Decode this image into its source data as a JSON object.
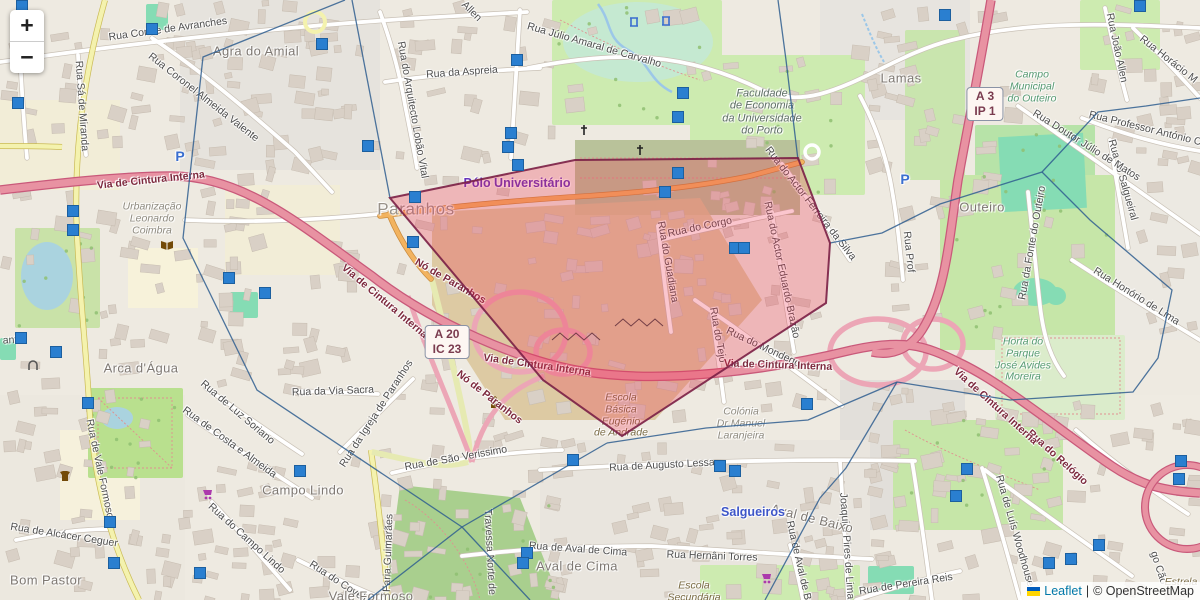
{
  "app": {
    "title": "Leaflet map — Paranhos / Porto"
  },
  "controls": {
    "zoom_in": "+",
    "zoom_out": "−"
  },
  "attribution": {
    "leaflet": "Leaflet",
    "divider": "|",
    "osm": "© OpenStreetMap",
    "flag_top": "#005BBB",
    "flag_bottom": "#FFD500"
  },
  "colors": {
    "highlight_fill": "#ef2e4b",
    "highlight_stroke": "#7a1f45",
    "cell_line": "#2f5e8f",
    "marker_blue": "#2a7fd0",
    "motorway_pink": "#e892a2",
    "leaflet_link": "#0078A8"
  },
  "shields": [
    {
      "lines": [
        "A 20",
        "IC 23"
      ],
      "x": 447,
      "y": 342
    },
    {
      "lines": [
        "A 3",
        "IP 1"
      ],
      "x": 985,
      "y": 104
    }
  ],
  "overlay": {
    "highlight_polygon": [
      [
        390,
        198
      ],
      [
        575,
        160
      ],
      [
        798,
        158
      ],
      [
        830,
        243
      ],
      [
        826,
        303
      ],
      [
        622,
        436
      ],
      [
        543,
        380
      ]
    ],
    "cells": [
      [
        [
          345,
          0
        ],
        [
          203,
          57
        ],
        [
          183,
          238
        ],
        [
          257,
          390
        ],
        [
          462,
          527
        ]
      ],
      [
        [
          462,
          527
        ],
        [
          368,
          600
        ]
      ],
      [
        [
          462,
          527
        ],
        [
          530,
          600
        ]
      ],
      [
        [
          462,
          527
        ],
        [
          607,
          443
        ]
      ],
      [
        [
          352,
          0
        ],
        [
          390,
          198
        ]
      ],
      [
        [
          778,
          0
        ],
        [
          786,
          60
        ],
        [
          798,
          160
        ]
      ],
      [
        [
          830,
          243
        ],
        [
          882,
          233
        ],
        [
          940,
          204
        ],
        [
          1042,
          172
        ],
        [
          1098,
          112
        ],
        [
          1146,
          106
        ],
        [
          1200,
          98
        ]
      ],
      [
        [
          1042,
          172
        ],
        [
          1090,
          220
        ],
        [
          1172,
          290
        ],
        [
          1158,
          358
        ],
        [
          1133,
          392
        ],
        [
          1010,
          400
        ],
        [
          897,
          382
        ]
      ],
      [
        [
          897,
          382
        ],
        [
          846,
          468
        ],
        [
          820,
          498
        ],
        [
          765,
          600
        ]
      ],
      [
        [
          607,
          443
        ],
        [
          706,
          428
        ],
        [
          808,
          420
        ],
        [
          897,
          382
        ]
      ]
    ]
  },
  "map": {
    "labels": [
      {
        "t": "Rua Conde de Avranches",
        "x": 168,
        "y": 30,
        "r": -8,
        "c": "st"
      },
      {
        "t": "Agra do Amial",
        "x": 256,
        "y": 52,
        "r": 0,
        "c": "place"
      },
      {
        "t": "Rua Coronel Almeida Valente",
        "x": 203,
        "y": 98,
        "r": 38,
        "c": "st"
      },
      {
        "t": "Rua Sá de Miranda",
        "x": 81,
        "y": 106,
        "r": 86,
        "c": "st"
      },
      {
        "t": "Rua do Arquitecto Lobão Vital",
        "x": 412,
        "y": 110,
        "r": 80,
        "c": "st"
      },
      {
        "t": "Rua da Aspreia",
        "x": 462,
        "y": 73,
        "r": -4,
        "c": "st"
      },
      {
        "t": "Rua Júlio Amaral de Carvalho",
        "x": 594,
        "y": 46,
        "r": 16,
        "c": "st"
      },
      {
        "t": "Allen",
        "x": 471,
        "y": 12,
        "r": 45,
        "c": "st"
      },
      {
        "t": "Rua João Allen",
        "x": 1116,
        "y": 48,
        "r": 78,
        "c": "st"
      },
      {
        "t": "Rua Horácio M",
        "x": 1168,
        "y": 60,
        "r": 38,
        "c": "st"
      },
      {
        "t": "Rua Professor António Cruz",
        "x": 1152,
        "y": 131,
        "r": 14,
        "c": "st"
      },
      {
        "t": "Rua do Salgueiral",
        "x": 1122,
        "y": 180,
        "r": 74,
        "c": "st"
      },
      {
        "t": "Rua Doutor Júlio de Matos",
        "x": 1086,
        "y": 146,
        "r": 32,
        "c": "st"
      },
      {
        "t": "Rua da Fonte do Outeiro",
        "x": 1033,
        "y": 243,
        "r": -80,
        "c": "st"
      },
      {
        "t": "Rua Honório de Lima",
        "x": 1136,
        "y": 297,
        "r": 32,
        "c": "st"
      },
      {
        "t": "Rua Prof",
        "x": 908,
        "y": 252,
        "r": 84,
        "c": "st"
      },
      {
        "t": "Rua do Corgo",
        "x": 700,
        "y": 228,
        "r": -12,
        "c": "st"
      },
      {
        "t": "Rua do Guadiana",
        "x": 667,
        "y": 262,
        "r": 80,
        "c": "st"
      },
      {
        "t": "Rua do Actor Eduardo Brazão",
        "x": 781,
        "y": 270,
        "r": 78,
        "c": "st"
      },
      {
        "t": "Rua do Actor Ferreira da Silva",
        "x": 810,
        "y": 204,
        "r": 52,
        "c": "st"
      },
      {
        "t": "Rua do Tejo",
        "x": 717,
        "y": 335,
        "r": 80,
        "c": "st"
      },
      {
        "t": "Rua do Mondego",
        "x": 763,
        "y": 348,
        "r": 25,
        "c": "st"
      },
      {
        "t": "Rua do Relógio",
        "x": 1057,
        "y": 458,
        "r": 42,
        "c": "mot"
      },
      {
        "t": "Joaquim Pires de Lima",
        "x": 846,
        "y": 546,
        "r": 86,
        "c": "st"
      },
      {
        "t": "Rua de Pereira Reis",
        "x": 906,
        "y": 585,
        "r": -9,
        "c": "st"
      },
      {
        "t": "Rua de Luís Woodhouse",
        "x": 1014,
        "y": 531,
        "r": 74,
        "c": "st"
      },
      {
        "t": "go Cão",
        "x": 1158,
        "y": 568,
        "r": 72,
        "c": "st"
      },
      {
        "t": "Rua de Augusto Lessa",
        "x": 662,
        "y": 466,
        "r": -3,
        "c": "st"
      },
      {
        "t": "Rua de São Verissimo",
        "x": 456,
        "y": 459,
        "r": -10,
        "c": "st"
      },
      {
        "t": "Travessa Norte de",
        "x": 489,
        "y": 552,
        "r": 87,
        "c": "st"
      },
      {
        "t": "Rua de Aval de Cima",
        "x": 578,
        "y": 550,
        "r": 4,
        "c": "st"
      },
      {
        "t": "Rua Hernâni Torres",
        "x": 712,
        "y": 557,
        "r": 2,
        "c": "st"
      },
      {
        "t": "Rua de Aval de Baixo",
        "x": 800,
        "y": 570,
        "r": 77,
        "c": "st"
      },
      {
        "t": "Rua do Campo Lindo",
        "x": 246,
        "y": 539,
        "r": 42,
        "c": "st"
      },
      {
        "t": "Rua de Luz Soriano",
        "x": 237,
        "y": 413,
        "r": 40,
        "c": "st"
      },
      {
        "t": "Rua de Costa e Almeida",
        "x": 229,
        "y": 443,
        "r": 36,
        "c": "st"
      },
      {
        "t": "Rua de Alcácer Ceguer",
        "x": 64,
        "y": 536,
        "r": 9,
        "c": "st"
      },
      {
        "t": "Rua de Vale Formoso",
        "x": 99,
        "y": 469,
        "r": 78,
        "c": "st"
      },
      {
        "t": "Faria Guimarães",
        "x": 389,
        "y": 553,
        "r": -88,
        "c": "st"
      },
      {
        "t": "Rua do Covelo",
        "x": 339,
        "y": 583,
        "r": 33,
        "c": "st"
      },
      {
        "t": "Rua da Via Sacra",
        "x": 333,
        "y": 392,
        "r": -2,
        "c": "st"
      },
      {
        "t": "Rua da Igreja de Paranhos",
        "x": 377,
        "y": 414,
        "r": -57,
        "c": "st"
      },
      {
        "t": "anto",
        "x": 13,
        "y": 341,
        "r": -3,
        "c": "st"
      },
      {
        "t": "Via de Cintura Interna",
        "x": 151,
        "y": 181,
        "r": -6,
        "c": "mot"
      },
      {
        "t": "Via de Cintura Interna",
        "x": 384,
        "y": 302,
        "r": 40,
        "c": "mot"
      },
      {
        "t": "Via de Cintura Interna",
        "x": 537,
        "y": 366,
        "r": 8,
        "c": "mot"
      },
      {
        "t": "Via de Cintura Interna",
        "x": 778,
        "y": 366,
        "r": 2,
        "c": "mot"
      },
      {
        "t": "Via de Cintura Interna",
        "x": 995,
        "y": 407,
        "r": 42,
        "c": "mot"
      },
      {
        "t": "Nó de Paranhos",
        "x": 450,
        "y": 282,
        "r": 30,
        "c": "mot"
      },
      {
        "t": "Nó de Paranhos",
        "x": 489,
        "y": 398,
        "r": 38,
        "c": "mot"
      },
      {
        "t": "Lamas",
        "x": 901,
        "y": 79,
        "r": 0,
        "c": "place"
      },
      {
        "t": "Outeiro",
        "x": 982,
        "y": 208,
        "r": 0,
        "c": "place"
      },
      {
        "t": "Paranhos",
        "x": 416,
        "y": 209,
        "r": 0,
        "c": "place-lg"
      },
      {
        "t": "Arca d'Água",
        "x": 141,
        "y": 369,
        "r": 0,
        "c": "place"
      },
      {
        "t": "Campo Lindo",
        "x": 303,
        "y": 491,
        "r": 0,
        "c": "place"
      },
      {
        "t": "Aval de Cima",
        "x": 577,
        "y": 567,
        "r": 0,
        "c": "place"
      },
      {
        "t": "Aval de Baixo",
        "x": 812,
        "y": 519,
        "r": 14,
        "c": "place"
      },
      {
        "t": "Bom Pastor",
        "x": 46,
        "y": 581,
        "r": 0,
        "c": "place"
      },
      {
        "t": "Vale Formoso",
        "x": 371,
        "y": 597,
        "r": 0,
        "c": "place"
      },
      {
        "t": "Salgueiros",
        "x": 753,
        "y": 512,
        "r": 0,
        "c": "place-blue"
      },
      {
        "t": "Pólo Universitário",
        "x": 517,
        "y": 183,
        "r": 0,
        "c": "purple"
      },
      {
        "t": "Estrela",
        "x": 1181,
        "y": 583,
        "r": 0,
        "c": "school-italic"
      },
      {
        "t": "P",
        "x": 180,
        "y": 157,
        "r": 0,
        "c": "p-icon"
      },
      {
        "t": "P",
        "x": 905,
        "y": 180,
        "r": 0,
        "c": "p-icon"
      },
      {
        "lines": [
          "Faculdade",
          "de Economia",
          "da Universidade",
          "do Porto"
        ],
        "x": 762,
        "y": 112,
        "c": "uni"
      },
      {
        "lines": [
          "Urbanização",
          "Leonardo",
          "Coimbra"
        ],
        "x": 152,
        "y": 219,
        "c": "muted-italic"
      },
      {
        "lines": [
          "Campo",
          "Municipal",
          "do Outeiro"
        ],
        "x": 1032,
        "y": 87,
        "c": "green-italic"
      },
      {
        "lines": [
          "Horta do",
          "Parque",
          "José Avides",
          "Moreira"
        ],
        "x": 1023,
        "y": 360,
        "c": "green-italic"
      },
      {
        "lines": [
          "Escola",
          "Básica",
          "Eugénio",
          "de Andrade"
        ],
        "x": 621,
        "y": 416,
        "c": "school-italic"
      },
      {
        "lines": [
          "Colónia",
          "Dr Manuel",
          "Laranjeira"
        ],
        "x": 741,
        "y": 424,
        "c": "muted-italic"
      },
      {
        "lines": [
          "Escola",
          "Secundária",
          "de António"
        ],
        "x": 694,
        "y": 598,
        "c": "school-italic"
      }
    ],
    "markers": [
      {
        "x": 22,
        "y": 6
      },
      {
        "x": 152,
        "y": 29
      },
      {
        "x": 322,
        "y": 44
      },
      {
        "x": 368,
        "y": 146
      },
      {
        "x": 517,
        "y": 60
      },
      {
        "x": 511,
        "y": 133
      },
      {
        "x": 508,
        "y": 147
      },
      {
        "x": 518,
        "y": 165
      },
      {
        "x": 678,
        "y": 117
      },
      {
        "x": 683,
        "y": 93
      },
      {
        "x": 678,
        "y": 173
      },
      {
        "x": 945,
        "y": 15
      },
      {
        "x": 1140,
        "y": 6
      },
      {
        "x": 18,
        "y": 103
      },
      {
        "x": 73,
        "y": 211
      },
      {
        "x": 73,
        "y": 230
      },
      {
        "x": 21,
        "y": 338
      },
      {
        "x": 56,
        "y": 352
      },
      {
        "x": 229,
        "y": 278
      },
      {
        "x": 265,
        "y": 293
      },
      {
        "x": 415,
        "y": 197
      },
      {
        "x": 413,
        "y": 242
      },
      {
        "x": 665,
        "y": 192
      },
      {
        "x": 735,
        "y": 248
      },
      {
        "x": 744,
        "y": 248
      },
      {
        "x": 88,
        "y": 403
      },
      {
        "x": 110,
        "y": 522
      },
      {
        "x": 114,
        "y": 563
      },
      {
        "x": 200,
        "y": 573
      },
      {
        "x": 300,
        "y": 471
      },
      {
        "x": 573,
        "y": 460
      },
      {
        "x": 527,
        "y": 553
      },
      {
        "x": 523,
        "y": 563
      },
      {
        "x": 720,
        "y": 466
      },
      {
        "x": 735,
        "y": 471
      },
      {
        "x": 807,
        "y": 404
      },
      {
        "x": 967,
        "y": 469
      },
      {
        "x": 956,
        "y": 496
      },
      {
        "x": 1049,
        "y": 563
      },
      {
        "x": 1071,
        "y": 559
      },
      {
        "x": 1099,
        "y": 545
      },
      {
        "x": 1181,
        "y": 461
      },
      {
        "x": 1179,
        "y": 479
      }
    ],
    "icons": [
      {
        "type": "church-icon",
        "x": 495,
        "y": 404
      },
      {
        "type": "cross-icon",
        "x": 640,
        "y": 151
      },
      {
        "type": "cross-icon",
        "x": 584,
        "y": 131
      },
      {
        "type": "library-book-icon",
        "x": 167,
        "y": 245
      },
      {
        "type": "supermarket-cart-icon",
        "x": 208,
        "y": 494
      },
      {
        "type": "supermarket-cart-icon",
        "x": 767,
        "y": 578
      },
      {
        "type": "clothes-shop-icon",
        "x": 65,
        "y": 476
      },
      {
        "type": "playground-icon",
        "x": 634,
        "y": 22
      },
      {
        "type": "playground-icon",
        "x": 666,
        "y": 21
      },
      {
        "type": "arch-icon",
        "x": 33,
        "y": 366
      }
    ]
  }
}
